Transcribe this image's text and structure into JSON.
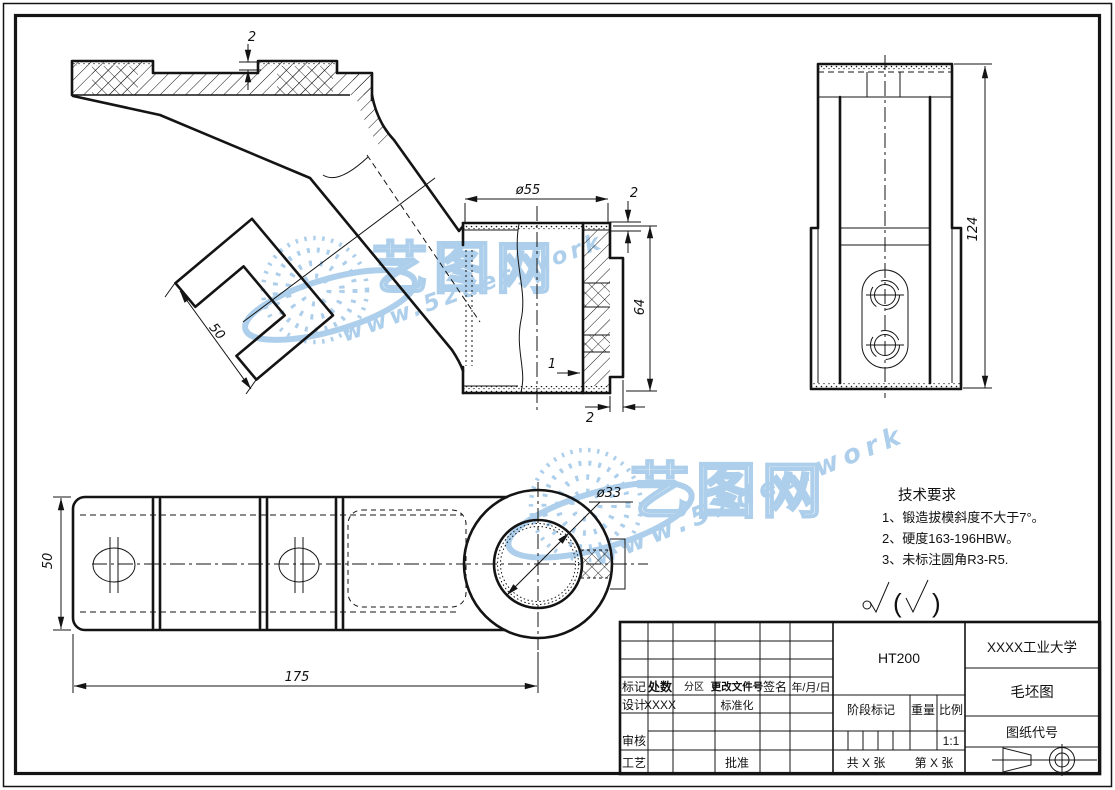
{
  "colors": {
    "line": "#141414",
    "watermark": "#a9cdea",
    "paper": "#ffffff"
  },
  "watermark": {
    "brand": "艺图网",
    "url": "www.52des.work"
  },
  "dims": {
    "plate_boss": "2",
    "fork_width": "50",
    "section_dia": "ø55",
    "section_h": "64",
    "section_top": "2",
    "section_step": "1",
    "section_bot": "2",
    "front_h": "124",
    "bar_w": "50",
    "bar_len": "175",
    "hole_dia": "ø33"
  },
  "tech": {
    "title": "技术要求",
    "l1": "1、锻造拔模斜度不大于7°。",
    "l2": "2、硬度163-196HBW。",
    "l3": "3、未标注圆角R3-R5.",
    "open": "(",
    "close": ")"
  },
  "tb": {
    "mark": "标记",
    "count": "处数",
    "zone": "分区",
    "file": "更改文件号",
    "sign": "签名",
    "date": "年/月/日",
    "design": "设计",
    "design_v": "XXXX",
    "std": "标准化",
    "review": "审核",
    "process": "工艺",
    "approve": "批准",
    "material": "HT200",
    "stage": "阶段标记",
    "weight": "重量",
    "scale": "比例",
    "scale_v": "1:1",
    "total": "共 X 张",
    "sheet": "第 X 张",
    "company": "XXXX工业大学",
    "title": "毛坯图",
    "code": "图纸代号"
  }
}
